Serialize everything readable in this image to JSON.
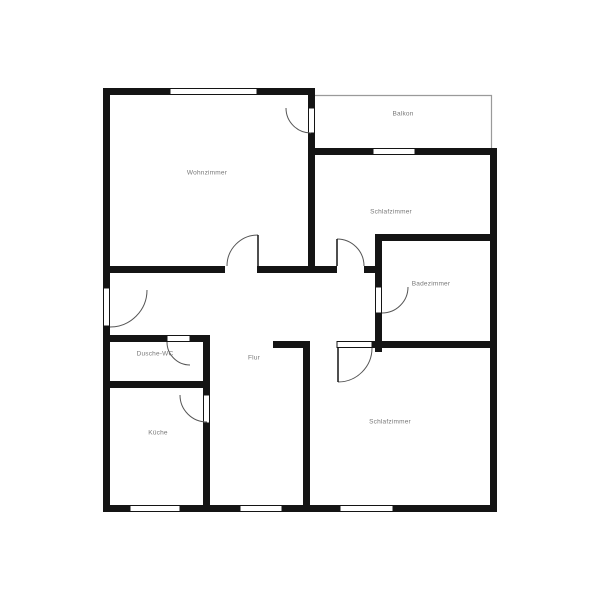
{
  "plan": {
    "type": "apartment-floor-plan",
    "rooms": [
      {
        "id": "wohnzimmer",
        "label": "Wohnzimmer"
      },
      {
        "id": "balkon",
        "label": "Balkon"
      },
      {
        "id": "schlafzimmer-oben",
        "label": "Schlafzimmer"
      },
      {
        "id": "badezimmer",
        "label": "Badezimmer"
      },
      {
        "id": "dusche-wc",
        "label": "Dusche-WC"
      },
      {
        "id": "flur",
        "label": "Flur"
      },
      {
        "id": "kueche",
        "label": "Küche"
      },
      {
        "id": "schlafzimmer-unten",
        "label": "Schlafzimmer"
      }
    ],
    "colors": {
      "wall": "#141414",
      "window_frame": "#141414",
      "door_arc": "#555555",
      "balcony_outline": "#9a9a9a",
      "label_text": "#787878",
      "background": "#ffffff"
    }
  }
}
